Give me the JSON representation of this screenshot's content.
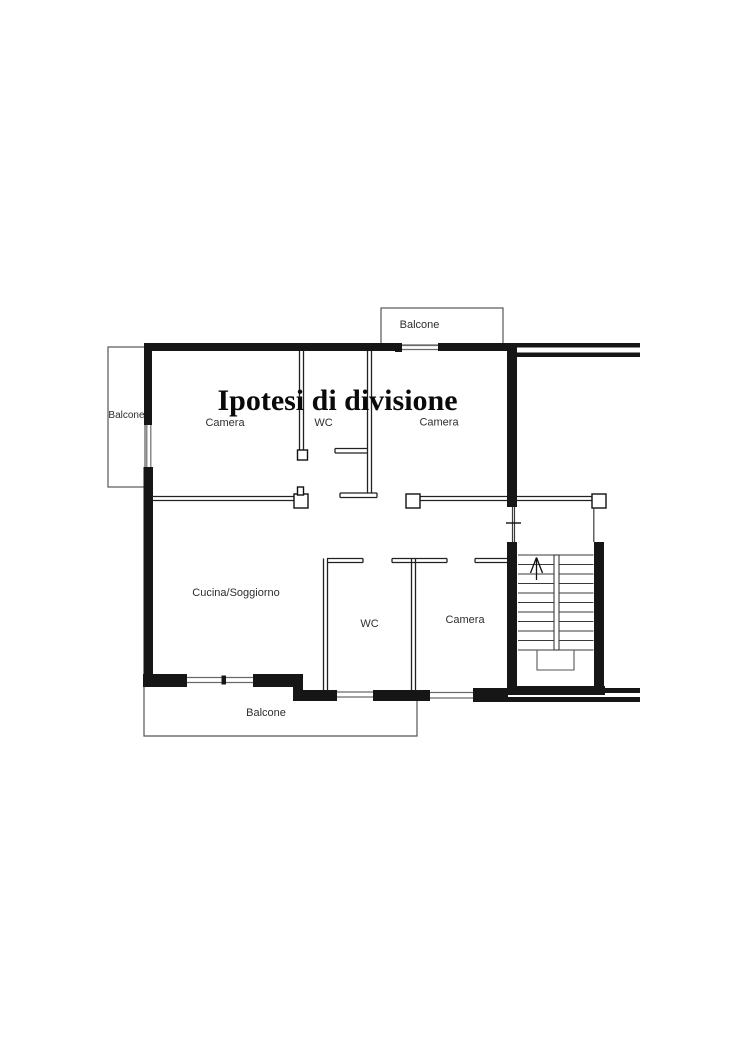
{
  "plan": {
    "title": "Ipotesi di divisione",
    "rooms": {
      "camera_top_left": "Camera",
      "wc_top": "WC",
      "camera_top_right": "Camera",
      "cucina_soggiorno": "Cucina/Soggiorno",
      "wc_bottom": "WC",
      "camera_bottom": "Camera"
    },
    "balconies": {
      "top": "Balcone",
      "left": "Balcone",
      "bottom": "Balcone"
    },
    "stairs": {
      "direction_icon": "up-arrow"
    },
    "colors": {
      "wall": "#161616",
      "partition_line": "#222222",
      "window_line": "#6a6a6a",
      "balcony_line": "#565656",
      "stair_line": "#3a3a3a",
      "label": "#2e2e2e",
      "background": "#ffffff"
    }
  }
}
